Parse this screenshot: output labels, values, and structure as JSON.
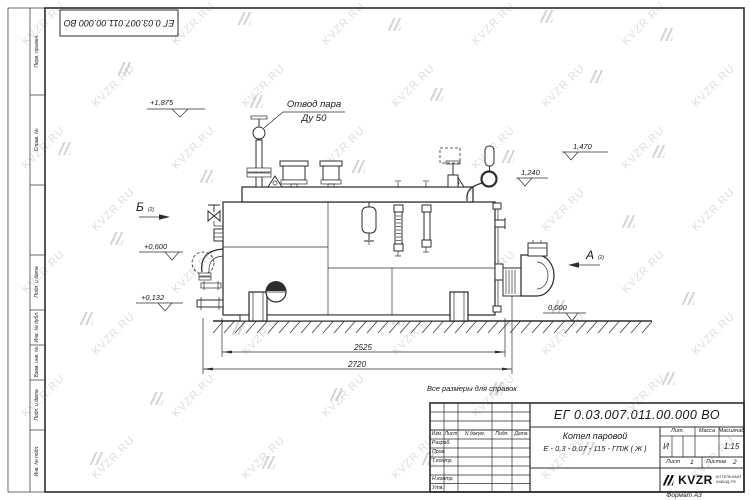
{
  "meta": {
    "note": "Все размеры для справок",
    "format_label": "Формат А3"
  },
  "corner_stamp": {
    "doc_number": "ЕГ 0.03.007.011.00.000  ВО"
  },
  "side_column": {
    "perv": "Перв. примен.",
    "sprav": "Справ. №",
    "podp1": "Подп. и дата",
    "inv_dubl": "Инв. № дубл.",
    "vzam": "Взам. инв. №",
    "podp2": "Подп. и дата",
    "inv_podl": "Инв. № подл."
  },
  "title_block": {
    "doc_number": "ЕГ 0.03.007.011.00.000  ВО",
    "product_name_line1": "Котел паровой",
    "product_name_line2": "Е - 0,3 - 0,07 - 115 - ГПЖ ( Ж )",
    "col_izm": "Изм.",
    "col_list": "Лист",
    "col_ndokum": "N докум.",
    "col_podp": "Подп.",
    "col_data": "Дата",
    "row_razrab": "Разраб.",
    "row_prov": "Пров.",
    "row_tkontr": "Т.контр.",
    "row_nkontr": "Н.контр.",
    "row_utv": "Утв.",
    "lit_header": "Лит.",
    "massa_header": "Масса",
    "masshtab_header": "Масштаб",
    "lit_value": "И",
    "masshtab_value": "1:15",
    "sheet_label": "Лист",
    "sheet_value": "1",
    "sheets_label": "Листов",
    "sheets_value": "2",
    "logo_text": "KVZR",
    "logo_sub1": "КОТЕЛЬНЫЙ",
    "logo_sub2": "ЗАВОД.РФ"
  },
  "annotations": {
    "steam_outlet_line1": "Отвод пара",
    "steam_outlet_line2": "Ду 50",
    "elev_1875": "+1,875",
    "elev_1470": "1,470",
    "elev_1240": "1,240",
    "elev_0600": "+0,600",
    "elev_0132": "+0,132",
    "elev_0000": "0,000",
    "view_b": "Б",
    "view_b_sub": "(2)",
    "view_a": "А",
    "view_a_sub": "(2)"
  },
  "dimensions": {
    "dim_inner": "2525",
    "dim_outer": "2720"
  },
  "watermark": {
    "text": "KVZR.RU"
  }
}
